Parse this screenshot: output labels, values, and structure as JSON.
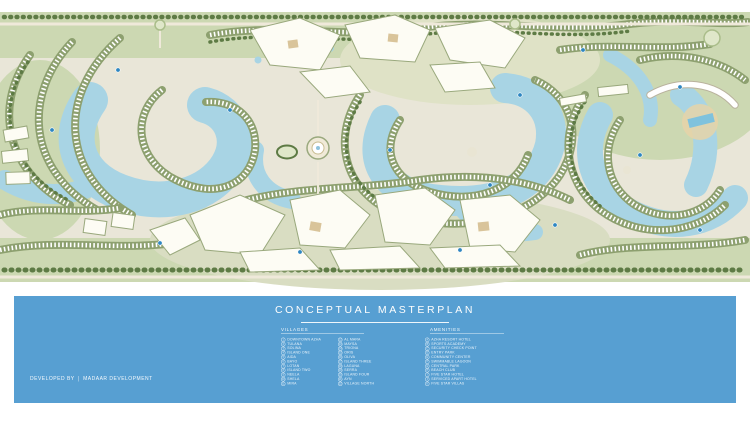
{
  "title": {
    "text": "CONCEPTUAL MASTERPLAN"
  },
  "developer": {
    "label": "DEVELOPED BY",
    "name": "MADAAR DEVELOPMENT"
  },
  "legend": {
    "villages": {
      "header": "VILLAGES",
      "col1": [
        {
          "n": "1",
          "label": "DOWNTOWN AZHA"
        },
        {
          "n": "2",
          "label": "TULANA"
        },
        {
          "n": "3",
          "label": "SOLINA"
        },
        {
          "n": "4",
          "label": "ISLAND ONE"
        },
        {
          "n": "5",
          "label": "AIDA"
        },
        {
          "n": "6",
          "label": "BAYO"
        },
        {
          "n": "7",
          "label": "LOTAN"
        },
        {
          "n": "8",
          "label": "ISLAND TWO"
        },
        {
          "n": "9",
          "label": "NEELA"
        },
        {
          "n": "10",
          "label": "SHELA"
        },
        {
          "n": "11",
          "label": "MIRA"
        }
      ],
      "col2": [
        {
          "n": "12",
          "label": "AL MARA"
        },
        {
          "n": "13",
          "label": "MAYSA"
        },
        {
          "n": "14",
          "label": "TRIONA"
        },
        {
          "n": "15",
          "label": "ORIS"
        },
        {
          "n": "16",
          "label": "OLIVA"
        },
        {
          "n": "17",
          "label": "ISLAND THREE"
        },
        {
          "n": "18",
          "label": "LAGUNA"
        },
        {
          "n": "19",
          "label": "SERRA"
        },
        {
          "n": "20",
          "label": "ISLAND FOUR"
        },
        {
          "n": "21",
          "label": "AYN"
        },
        {
          "n": "22",
          "label": "VILLAGE NORTH"
        }
      ]
    },
    "amenities": {
      "header": "AMENITIES",
      "items": [
        {
          "n": "A",
          "label": "AZHA RESORT HOTEL"
        },
        {
          "n": "B",
          "label": "SPORTS ACADEMY"
        },
        {
          "n": "C",
          "label": "SECURITY CHECK POINT"
        },
        {
          "n": "D",
          "label": "ENTRY PARK"
        },
        {
          "n": "E",
          "label": "COMMUNITY CENTER"
        },
        {
          "n": "F",
          "label": "SWIMMABLE LAGOON"
        },
        {
          "n": "G",
          "label": "CENTRAL PARK"
        },
        {
          "n": "H",
          "label": "BEACH CLUB"
        },
        {
          "n": "I",
          "label": "FIVE STAR HOTEL"
        },
        {
          "n": "J",
          "label": "SERVICED APART HOTEL"
        },
        {
          "n": "K",
          "label": "FIVE STAR VILLAS"
        }
      ]
    }
  },
  "colors": {
    "band_blue": "#579fd2",
    "lagoon_water": "#a8d4e4",
    "greenery": "#ccd8b2",
    "villa_strip": "#8da06f",
    "marker_blue": "#2e86c1"
  }
}
